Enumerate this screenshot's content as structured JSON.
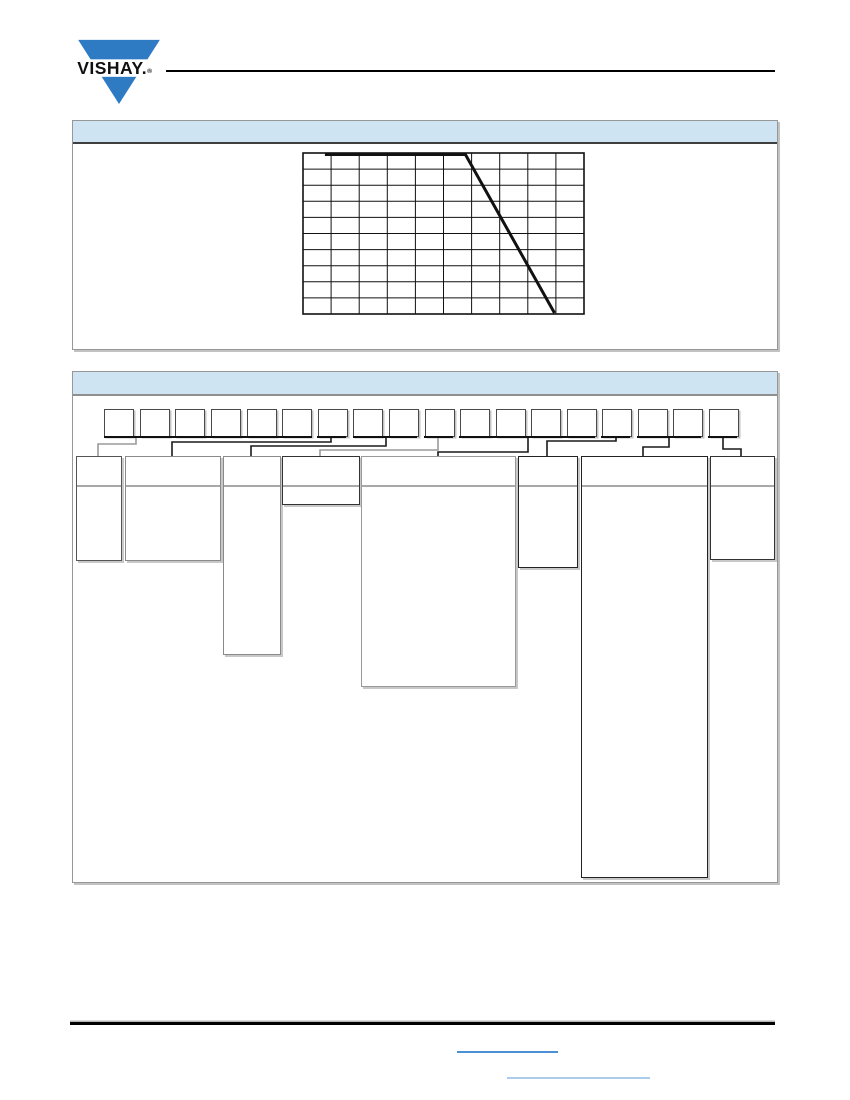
{
  "page": {
    "width": 850,
    "height": 1100,
    "background": "#ffffff"
  },
  "logo": {
    "brand_text": "VISHAY.",
    "registered_mark": "®",
    "triangle_color": "#2e7bc4",
    "text_color": "#101010"
  },
  "header_rule": {
    "x": 166,
    "y": 70,
    "width": 609,
    "height": 2,
    "color": "#000000"
  },
  "sections": [
    {
      "name": "derating-graph-panel",
      "x": 72,
      "y": 120,
      "width": 704,
      "height": 228,
      "header_height": 21,
      "header_bg": "#cfe4f3",
      "header_border_bottom": "#3f3f3f",
      "header_text": ""
    },
    {
      "name": "part-number-panel",
      "x": 72,
      "y": 371,
      "width": 704,
      "height": 510,
      "header_height": 22,
      "header_bg": "#cfe4f3",
      "header_border_bottom": "#8f8f8f",
      "header_text": ""
    }
  ],
  "chart_data": {
    "type": "line",
    "title": "",
    "xlabel": "",
    "ylabel": "",
    "axis_labels_visible": false,
    "grid": {
      "cols": 10,
      "rows": 10,
      "line_color": "#111111"
    },
    "plot_box": {
      "left": 228,
      "top": 30,
      "width": 281,
      "height": 161
    },
    "series": [
      {
        "name": "derating-curve",
        "color": "#111111",
        "stroke_width": 3,
        "points_fraction": [
          [
            0.078,
            1.0
          ],
          [
            0.578,
            1.0
          ],
          [
            0.895,
            0.0
          ]
        ]
      }
    ],
    "note": "10x10 grid; curve is flat at 100% from ~8% to ~58% of the x-range, then descends linearly to 0% at ~90% of the x-range; no tick or axis text is rendered in the image"
  },
  "part_number_diagram": {
    "char_box": {
      "top": 37,
      "width": 28,
      "height": 26,
      "border_color": "#4a4a4a"
    },
    "char_box_lefts": [
      31,
      67,
      102,
      138,
      174,
      209,
      245,
      280,
      316,
      352,
      387,
      423,
      458,
      494,
      529,
      565,
      600,
      636
    ],
    "underline": {
      "y": 64,
      "thickness": 2,
      "color": "#101010"
    },
    "underline_groups": [
      {
        "x1": 31,
        "x2": 239
      },
      {
        "x1": 244,
        "x2": 273
      },
      {
        "x1": 280,
        "x2": 344
      },
      {
        "x1": 351,
        "x2": 380
      },
      {
        "x1": 386,
        "x2": 522
      },
      {
        "x1": 528,
        "x2": 557
      },
      {
        "x1": 564,
        "x2": 628
      },
      {
        "x1": 635,
        "x2": 664
      }
    ],
    "connectors": [
      {
        "color": "#9a9a9a",
        "points": [
          [
            63,
            66
          ],
          [
            63,
            72
          ],
          [
            25,
            72
          ],
          [
            25,
            84
          ]
        ]
      },
      {
        "color": "#1a1a1a",
        "points": [
          [
            258,
            66
          ],
          [
            258,
            70
          ],
          [
            99,
            70
          ],
          [
            99,
            84
          ]
        ]
      },
      {
        "color": "#1a1a1a",
        "points": [
          [
            313,
            66
          ],
          [
            313,
            74
          ],
          [
            178,
            74
          ],
          [
            178,
            84
          ]
        ]
      },
      {
        "color": "#9a9a9a",
        "points": [
          [
            365,
            66
          ],
          [
            365,
            78
          ],
          [
            247,
            78
          ],
          [
            247,
            84
          ]
        ]
      },
      {
        "color": "#1a1a1a",
        "points": [
          [
            455,
            66
          ],
          [
            455,
            80
          ],
          [
            365,
            80
          ],
          [
            365,
            84
          ]
        ]
      },
      {
        "color": "#1a1a1a",
        "points": [
          [
            543,
            66
          ],
          [
            543,
            69
          ],
          [
            474,
            69
          ],
          [
            474,
            84
          ]
        ]
      },
      {
        "color": "#1a1a1a",
        "points": [
          [
            596,
            66
          ],
          [
            596,
            75
          ],
          [
            570,
            75
          ],
          [
            570,
            84
          ]
        ]
      },
      {
        "color": "#1a1a1a",
        "points": [
          [
            650,
            66
          ],
          [
            650,
            77
          ],
          [
            668,
            77
          ],
          [
            668,
            84
          ]
        ]
      }
    ],
    "description_boxes": [
      {
        "left": 3,
        "top": 84,
        "width": 44,
        "height": 103,
        "header_height": 28,
        "border_color": "#555555",
        "divider_color": "#a8a8a8"
      },
      {
        "left": 52,
        "top": 84,
        "width": 94,
        "height": 103,
        "header_height": 28,
        "border_color": "#8a8a8a",
        "divider_color": "#a8a8a8"
      },
      {
        "left": 150,
        "top": 84,
        "width": 56,
        "height": 197,
        "header_height": 28,
        "border_color": "#8a8a8a",
        "divider_color": "#a8a8a8"
      },
      {
        "left": 209,
        "top": 84,
        "width": 76,
        "height": 47,
        "header_height": 28,
        "border_color": "#333333",
        "divider_color": "#a8a8a8"
      },
      {
        "left": 288,
        "top": 84,
        "width": 153,
        "height": 229,
        "header_height": 28,
        "border_color": "#999999",
        "divider_color": "#a8a8a8"
      },
      {
        "left": 445,
        "top": 84,
        "width": 58,
        "height": 110,
        "header_height": 28,
        "border_color": "#222222",
        "divider_color": "#a8a8a8"
      },
      {
        "left": 508,
        "top": 84,
        "width": 125,
        "height": 420,
        "header_height": 28,
        "border_color": "#222222",
        "divider_color": "#a8a8a8"
      },
      {
        "left": 637,
        "top": 84,
        "width": 63,
        "height": 102,
        "header_height": 28,
        "border_color": "#333333",
        "divider_color": "#a8a8a8"
      }
    ]
  },
  "footer": {
    "rule": {
      "x": 70,
      "y": 1022,
      "width": 705,
      "height": 3,
      "color": "#000000"
    },
    "links": [
      {
        "x": 457,
        "y": 1051,
        "width": 101,
        "height": 2,
        "color": "#4a90d2",
        "text": ""
      },
      {
        "x": 507,
        "y": 1077,
        "width": 143,
        "height": 2,
        "color": "#abcdeb",
        "text": ""
      }
    ]
  }
}
